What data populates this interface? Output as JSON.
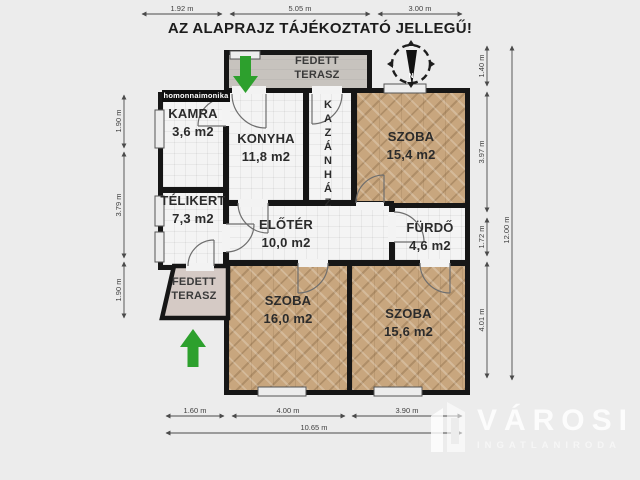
{
  "title": "AZ ALAPRAJZ TÁJÉKOZTATÓ JELLEGŰ!",
  "watermark": {
    "credit": "homonnaimonika"
  },
  "brand": {
    "name": "VÁROSI",
    "sub": "INGATLANIRODA"
  },
  "compass": {
    "label": "N"
  },
  "rooms": {
    "terasz_top": {
      "name": "FEDETT TERASZ"
    },
    "kamra": {
      "name": "KAMRA",
      "area": "3,6 m2"
    },
    "konyha": {
      "name": "KONYHA",
      "area": "11,8 m2"
    },
    "kazanhaz": {
      "name": "KAZÁNHÁZ"
    },
    "szoba_ne": {
      "name": "SZOBA",
      "area": "15,4 m2"
    },
    "telikert": {
      "name": "TÉLIKERT",
      "area": "7,3 m2"
    },
    "eloter": {
      "name": "ELŐTÉR",
      "area": "10,0 m2"
    },
    "furdo": {
      "name": "FÜRDŐ",
      "area": "4,6 m2"
    },
    "terasz_bottom": {
      "name": "FEDETT TERASZ"
    },
    "szoba_sw": {
      "name": "SZOBA",
      "area": "16,0 m2"
    },
    "szoba_se": {
      "name": "SZOBA",
      "area": "15,6 m2"
    }
  },
  "dimensions": {
    "top": [
      "1.92 m",
      "5.05 m",
      "3.00 m"
    ],
    "left": [
      "1.90 m",
      "3.79 m",
      "1.90 m"
    ],
    "right_inner": [
      "1.40 m",
      "3.97 m",
      "1.72 m",
      "4.01 m"
    ],
    "right_total": "12.00 m",
    "bottom_inner": [
      "1.60 m",
      "4.00 m",
      "3.90 m"
    ],
    "bottom_total": "10.65 m"
  },
  "colors": {
    "wall": "#161616",
    "wood_floor": "#c8a67e",
    "tile_floor": "#f4f4f4",
    "terrace": "#c7c3be",
    "terrace_lower": "#d5cac5",
    "arrow_green": "#2da02d",
    "background": "#ececec"
  }
}
